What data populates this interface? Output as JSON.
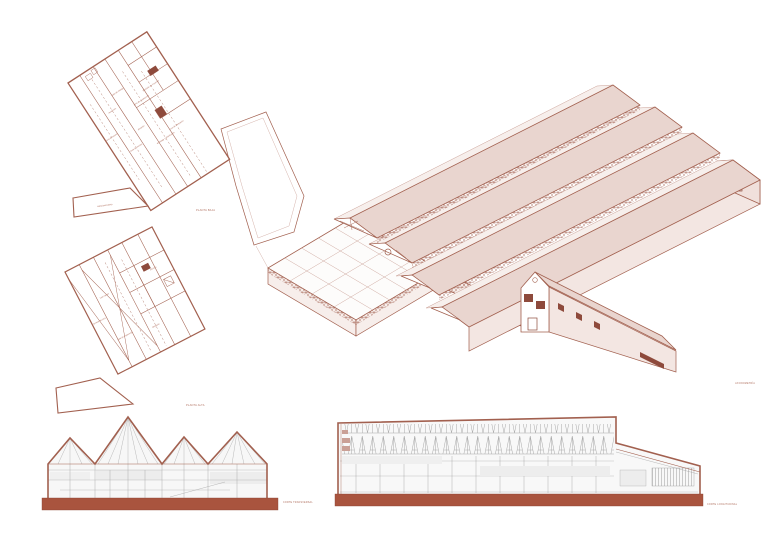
{
  "sheet": {
    "palette": {
      "line": "#a2604f",
      "line_light": "#caa096",
      "fill_pink": "#e9d5cf",
      "fill_pink_light": "#f3e6e2",
      "slab_red": "#a9543e",
      "gray_line": "#9b9b9b",
      "label_red": "#b0705f"
    },
    "drawings": {
      "plan_ground": {
        "caption": "PLANTA BAJA",
        "labels": [
          "zona de acceso",
          "recepción",
          "área de ventas",
          "sala de trabajo",
          "almacén",
          "zona de producción",
          "embalaje y distribución",
          "depósito de insumos",
          "zona de despacho",
          "estacionamiento"
        ]
      },
      "plan_roof": {
        "caption": "PLANTA ALTA",
        "labels": [
          "terraza técnica",
          "lucernarios",
          "sala de exposición",
          "depósito",
          "oficinas"
        ]
      },
      "axonometric": {
        "caption": "AXONOMETRÍA"
      },
      "section_cross": {
        "caption": "CORTE TRANSVERSAL"
      },
      "section_long": {
        "caption": "CORTE LONGITUDINAL"
      }
    }
  }
}
